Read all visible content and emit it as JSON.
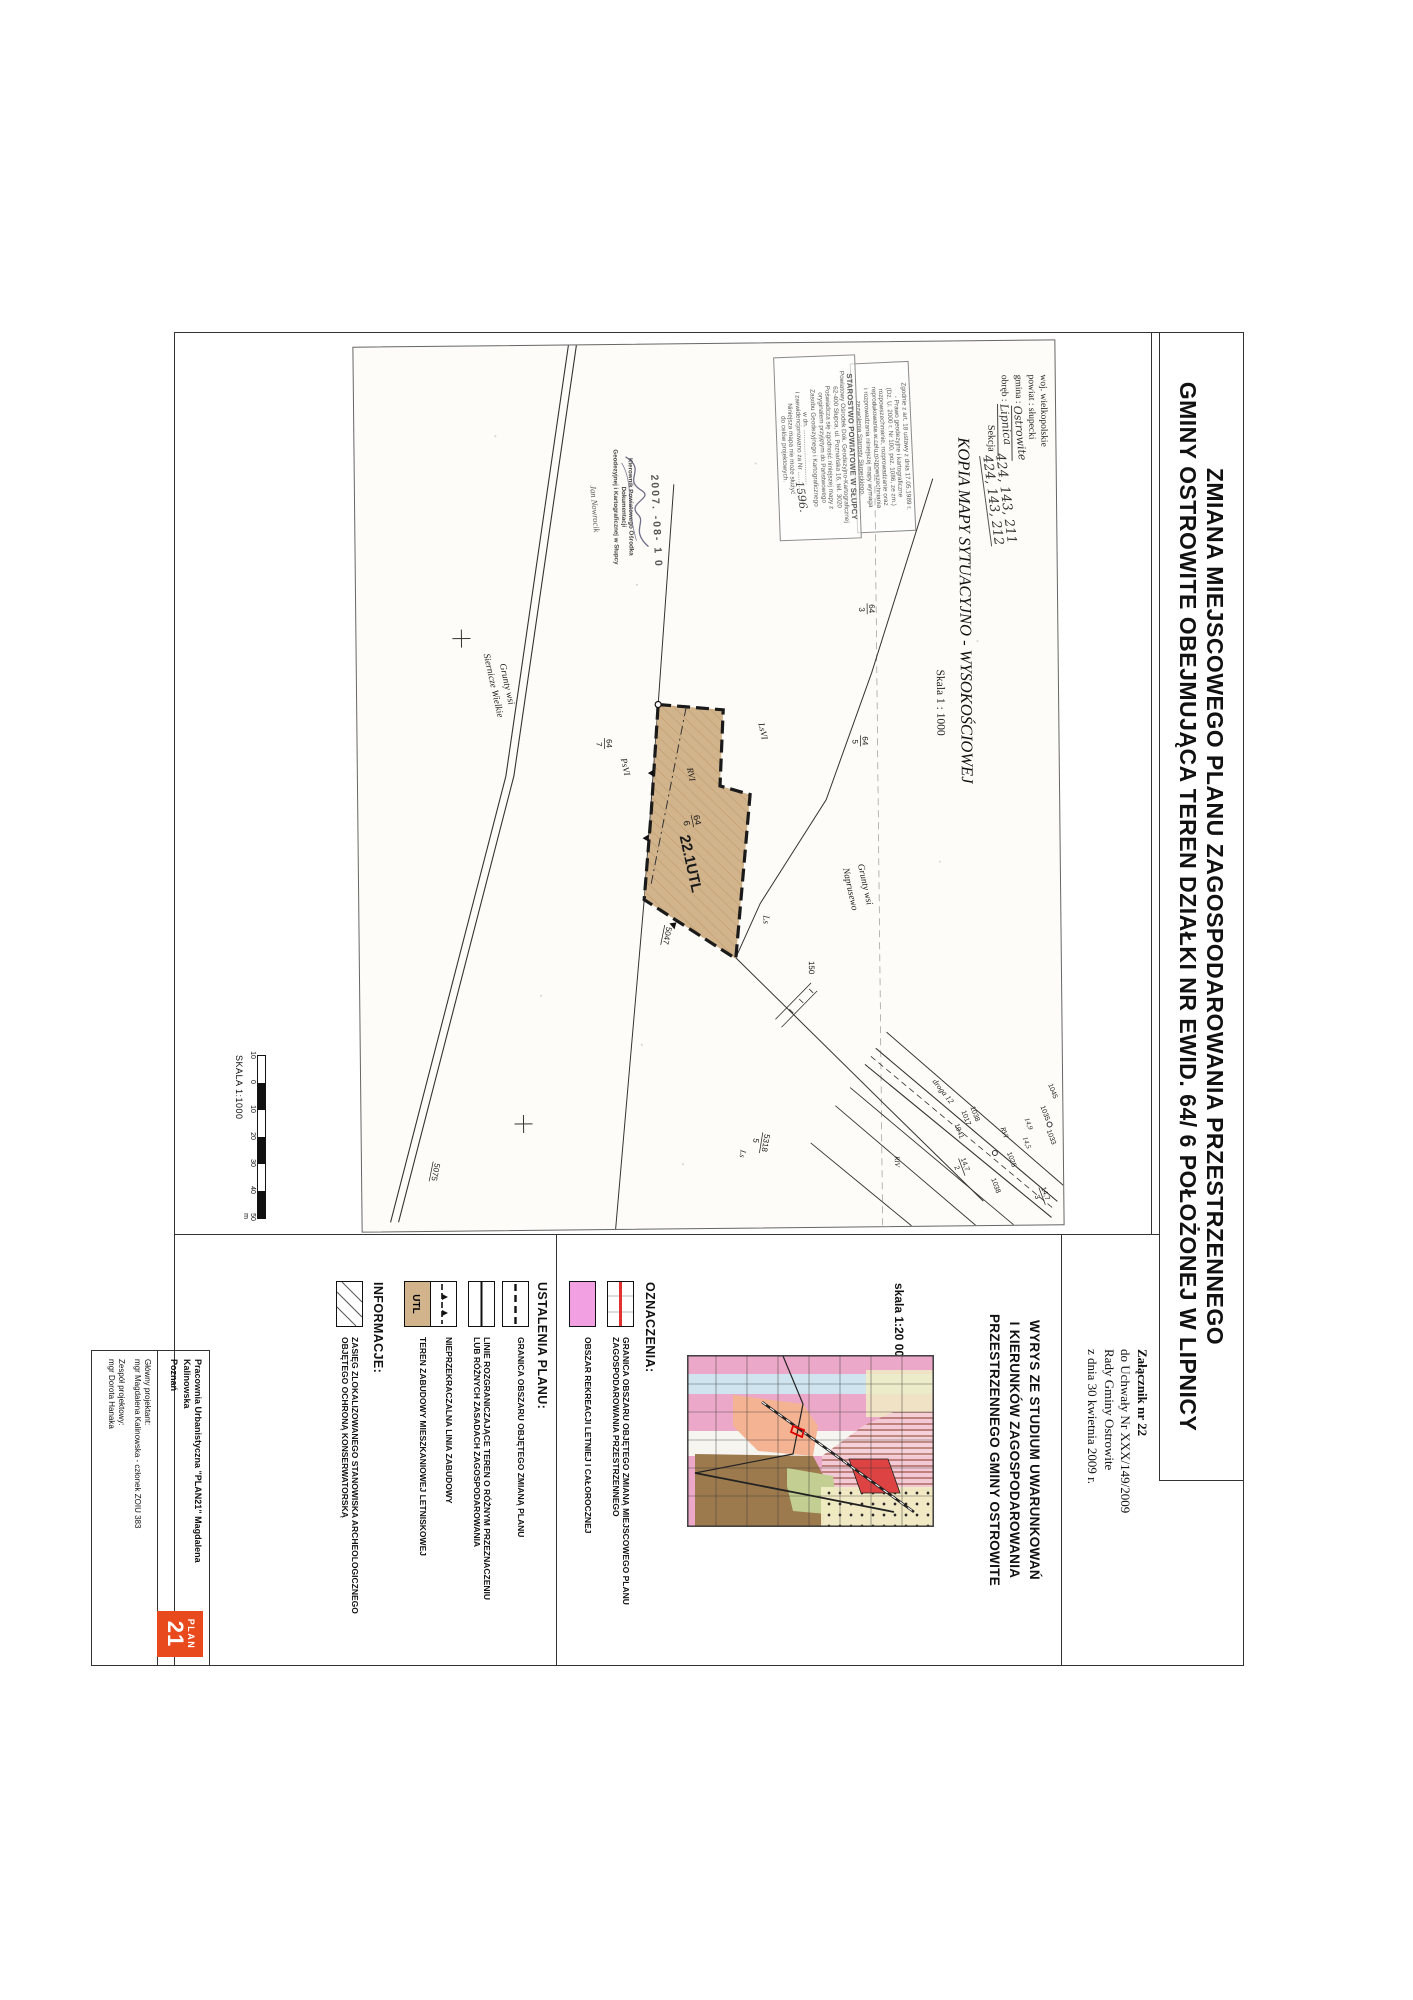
{
  "title": {
    "line1": "ZMIANA MIEJSCOWEGO PLANU ZAGOSPODAROWANIA PRZESTRZENNEGO",
    "line2": "GMINY OSTROWITE OBEJMUJĄCA TEREN DZIAŁKI NR EWID. 64/ 6 POŁOŻONEJ W LIPNICY"
  },
  "attachment": {
    "lines": [
      "Załącznik nr 22",
      "do Uchwały Nr XXX/149/2009",
      "Rady Gminy Ostrowite",
      "z dnia 30 kwietnia 2009 r."
    ]
  },
  "map_header": {
    "woj": "woj. wielkopolskie",
    "powiat": "powiat : słupecki",
    "gmina_label": "gmina :",
    "gmina_value": "Ostrowite",
    "obreb_label": "obręb :",
    "obreb_value": "Lipnica",
    "sekcja_label": "Sekcja",
    "sekcja_line1": "424, 143, 211",
    "sekcja_line2": "424, 143, 212",
    "kopia_title": "KOPIA MAPY SYTUACYJNO - WYSOKOŚCIOWEJ",
    "skala": "Skala 1 : 1000"
  },
  "stamp1": {
    "lines": [
      "Zgodnie z art. 18 ustawy z dnia 17.05.1989 r.",
      "- Prawo geodezyjne i kartograficzne",
      "(Dz. U. 2000 r. Nr 100, poz. 1086, ze zm.)",
      "rozpowszechnianie, rozprowadzanie oraz",
      "reprodukowanie w celu rozpowszechniania",
      "i rozprowadzania niniejszej mapy wymaga",
      "zezwolenia Starosty Słupeckiego."
    ]
  },
  "stamp2": {
    "title": "STAROSTWO POWIATOWE W SŁUPCY",
    "lines": [
      "Powiatowy Ośrodek Dok. Geodezyjno-Kartograficznej",
      "62-400 Słupca, ul. Poznańska 16, tel. 3020",
      "Poświadcza się zgodność niniejszej mapy z",
      "oryginałem przyjętym do Państwowego",
      "Zasobu Geodezyjnego i Kartograficznego",
      "w dn. ...............................",
      "i zaewidencjonowano za Nr ...................",
      "Niniejsza mapa nie może służyć",
      "do celów projektowych."
    ]
  },
  "handwritten_number": "1596.",
  "date_stamp": "2007. -08- 1 0",
  "kierownik": {
    "lines": [
      "Kierownik Powiatowego Ośrodka Dokumentacji",
      "Geodezyjnej i Kartograficznej w Słupcy"
    ],
    "signature_name": "Jan Nowrocik"
  },
  "scalebar": {
    "label": "SKALA 1:1000",
    "ticks": [
      "10",
      "0",
      "10",
      "20",
      "30",
      "40",
      "50"
    ],
    "unit": "m"
  },
  "map": {
    "parcel_label": "22.1UTL",
    "labels": [
      {
        "t": "22.1UTL",
        "x": 492,
        "y": 380,
        "s": 15,
        "b": 1,
        "r": -12
      },
      {
        "n": "64",
        "d": "6",
        "x": 472,
        "y": 368,
        "s": 9,
        "r": -12
      },
      {
        "t": "RVI",
        "x": 424,
        "y": 372,
        "s": 9,
        "i": 1,
        "r": -12
      },
      {
        "t": "PsVI",
        "x": 414,
        "y": 438,
        "s": 9,
        "i": 1,
        "r": -12
      },
      {
        "t": "LsVI",
        "x": 380,
        "y": 300,
        "s": 9,
        "i": 1,
        "r": -12
      },
      {
        "t": "Ls",
        "x": 572,
        "y": 297,
        "s": 9,
        "i": 1
      },
      {
        "n": "64",
        "d": "3",
        "x": 262,
        "y": 190,
        "s": 8
      },
      {
        "n": "64",
        "d": "5",
        "x": 394,
        "y": 198,
        "s": 8
      },
      {
        "n": "64",
        "d": "7",
        "x": 394,
        "y": 454,
        "s": 8
      },
      {
        "t": "Grunty wsi",
        "x": 318,
        "y": 558,
        "s": 9.5,
        "i": 1,
        "r": -12
      },
      {
        "t": "Siernicze Wielkie",
        "x": 308,
        "y": 574,
        "s": 9.5,
        "i": 1,
        "r": -12
      },
      {
        "t": "Grunty wsi",
        "x": 522,
        "y": 202,
        "s": 9.5,
        "i": 1,
        "r": -12
      },
      {
        "t": "Naprusewo",
        "x": 526,
        "y": 217,
        "s": 9.5,
        "i": 1,
        "r": -12
      },
      {
        "t": "150",
        "x": 618,
        "y": 252,
        "s": 8
      },
      {
        "n": "5318",
        "d": "5",
        "x": 790,
        "y": 300,
        "s": 8,
        "r": 10
      },
      {
        "t": "Ls",
        "x": 806,
        "y": 322,
        "s": 8,
        "i": 1,
        "r": 10
      },
      {
        "t": "5047",
        "x": 582,
        "y": 394,
        "s": 8,
        "r": 12,
        "u": 1
      },
      {
        "t": "5075",
        "x": 816,
        "y": 628,
        "s": 8,
        "r": 12,
        "u": 1
      },
      {
        "t": "droga 12",
        "x": 740,
        "y": 130,
        "s": 8,
        "i": 1,
        "r": -38
      },
      {
        "t": "1045",
        "x": 744,
        "y": 14,
        "s": 7,
        "r": -20
      },
      {
        "t": "1035",
        "x": 766,
        "y": 22,
        "s": 7,
        "r": -20
      },
      {
        "t": "1033",
        "x": 790,
        "y": 16,
        "s": 7,
        "r": -20
      },
      {
        "t": "14,9",
        "x": 778,
        "y": 38,
        "s": 7,
        "i": 1,
        "r": -20
      },
      {
        "t": "14,5",
        "x": 797,
        "y": 40,
        "s": 7,
        "i": 1,
        "r": -20
      },
      {
        "t": "RVI",
        "x": 787,
        "y": 62,
        "s": 7,
        "i": 1,
        "r": -20
      },
      {
        "t": "1025",
        "x": 812,
        "y": 56,
        "s": 7,
        "r": -20
      },
      {
        "t": "1038",
        "x": 838,
        "y": 72,
        "s": 7,
        "r": -20
      },
      {
        "t": "1038",
        "x": 766,
        "y": 92,
        "s": 7,
        "r": -20
      },
      {
        "t": "1017",
        "x": 770,
        "y": 101,
        "s": 7,
        "r": -20
      },
      {
        "t": "1041",
        "x": 783,
        "y": 108,
        "s": 7,
        "r": -20
      },
      {
        "n": "14,7",
        "d": "2",
        "x": 818,
        "y": 104,
        "s": 7,
        "r": -20
      },
      {
        "n": "14,7",
        "d": "3",
        "x": 848,
        "y": 24,
        "s": 7,
        "r": -20
      },
      {
        "t": "RIV",
        "x": 814,
        "y": 168,
        "s": 7,
        "i": 1
      }
    ]
  },
  "legend": {
    "wyrys_heading": [
      "WYRYS ZE STUDIUM UWARUNKOWAŃ",
      "I KIERUNKÓW ZAGOSPODAROWANIA",
      "PRZESTRZENNEGO GMINY OSTROWITE"
    ],
    "skala_note": "skala 1:20 000",
    "oznaczenia": {
      "heading": "OZNACZENIA:",
      "entries": [
        {
          "symbol": "red-line",
          "lines": [
            "GRANICA OBSZARU OBJĘTEGO ZMIANĄ MIEJSCOWEGO PLANU",
            "ZAGOSPODAROWANIA PRZESTRZENNEGO"
          ]
        },
        {
          "symbol": "pink-fill",
          "lines": [
            "OBSZAR REKREACJI LETNIEJ I CAŁOROCZNEJ"
          ]
        }
      ]
    },
    "ustalenia": {
      "heading": "USTALENIA PLANU:",
      "entries": [
        {
          "symbol": "dash-line",
          "lines": [
            "GRANICA OBSZARU OBJĘTEGO ZMIANĄ PLANU"
          ]
        },
        {
          "symbol": "solid-line",
          "lines": [
            "LINIE ROZGRANICZAJĄCE TEREN O RÓŻNYM PRZEZNACZENIU",
            "LUB RÓŻNYCH ZASADACH ZAGOSPODAROWANIA"
          ]
        },
        {
          "symbol": "setback-line",
          "lines": [
            "NIEPRZEKRACZALNA LINIA ZABUDOWY"
          ]
        },
        {
          "symbol": "utl-fill",
          "lines": [
            "TEREN ZABUDOWY MIESZKANIOWEJ LETNISKOWEJ"
          ]
        }
      ],
      "utl_label": "UTL"
    },
    "informacje": {
      "heading": "INFORMACJE:",
      "entries": [
        {
          "symbol": "hatch",
          "lines": [
            "ZASIĘG ZLOKALIZOWANEGO STANOWISKA ARCHEOLOGICZNEGO",
            "OBJĘTEGO OCHRONĄ KONSERWATORSKĄ"
          ]
        }
      ]
    }
  },
  "footer": {
    "office_line1": "Pracownia Urbanistyczna \"PLAN21\" Magdalena Kalinowska",
    "office_line2": "Poznań",
    "role1": "Główny projektant:",
    "person1": "mgr Magdalena Kalinowska - członek ZOIU 383",
    "role2": "Zespół projektowy:",
    "person2": "mgr Dorota Hanaka",
    "logo_text_top": "PLAN",
    "logo_text_big": "21"
  },
  "colors": {
    "parcel_tan": "#D2B48C",
    "parcel_hatch": "#C09A6C",
    "legend_pink": "#F2A0E2",
    "logo_orange": "#E8491D",
    "stamp_ink": "#5A5A5A",
    "accent_red": "#E03030",
    "mm_pink": "#ECA8C8",
    "mm_blue": "#CFE4EF",
    "mm_salmon": "#F4B392",
    "mm_olive": "#9C7A4E",
    "mm_green": "#C3CF92",
    "mm_yellow": "#F1ECC3",
    "mm_red": "#DD4343",
    "mm_hatchbg": "#F5CDD8",
    "mm_hatchln": "#A05A4A"
  }
}
